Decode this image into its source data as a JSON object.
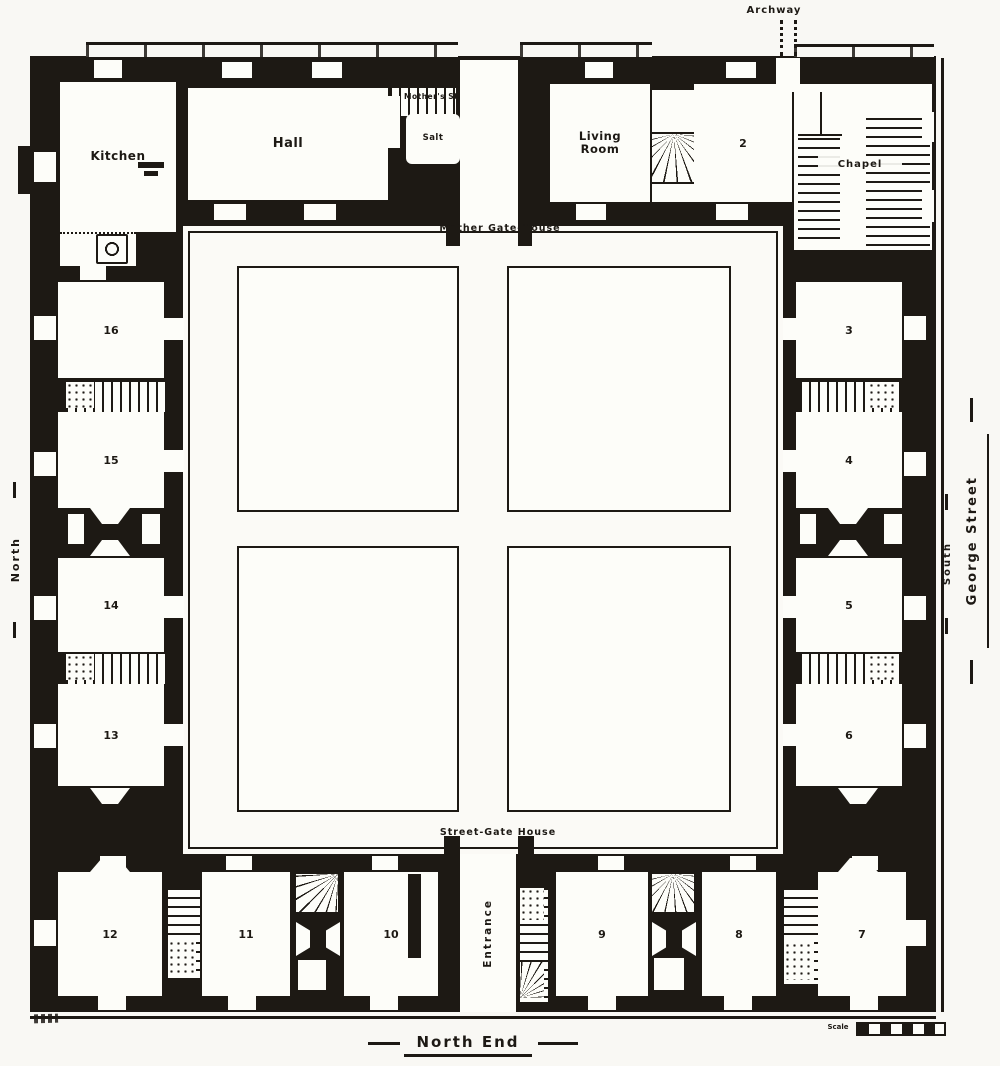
{
  "page": {
    "background": "#f9f8f4",
    "ink": "#1d1914"
  },
  "labels": {
    "archway": "Archway",
    "mother_gatehouse": "Mother Gate-House",
    "street_gatehouse": "Street-Gate House",
    "mothers_stairs": "Mother's Stairs",
    "salt": "Salt",
    "entrance": "Entrance",
    "north": "North",
    "south": "South",
    "george_street": "George Street",
    "north_end": "North End",
    "scale": "Scale"
  },
  "rooms": {
    "kitchen": "Kitchen",
    "hall": "Hall",
    "living_room": "Living\nRoom",
    "chapel": "Chapel",
    "r2": "2",
    "r3": "3",
    "r4": "4",
    "r5": "5",
    "r6": "6",
    "r7": "7",
    "r8": "8",
    "r9": "9",
    "r10": "10",
    "r11": "11",
    "r12": "12",
    "r13": "13",
    "r14": "14",
    "r15": "15",
    "r16": "16"
  }
}
